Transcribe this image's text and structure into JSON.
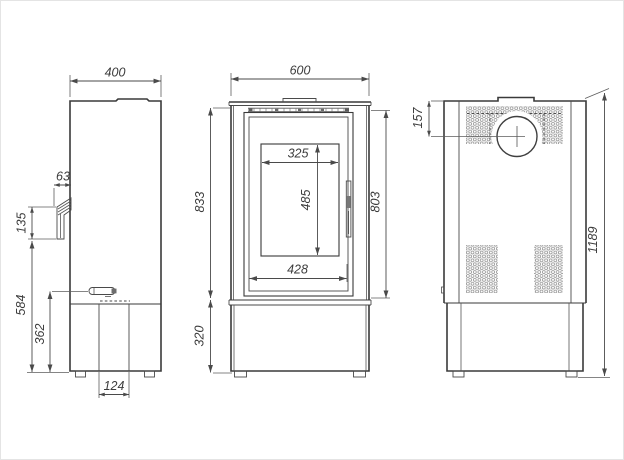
{
  "drawing": {
    "side": {
      "depth": "400",
      "rear_offset": "63",
      "bracket_height": "135",
      "outlet_to_floor": "584",
      "lever_to_floor": "362",
      "base_opening_width": "124"
    },
    "front": {
      "width": "600",
      "body_height": "833",
      "door_height": "803",
      "glass_width": "325",
      "glass_height": "485",
      "door_width": "428",
      "base_height": "320"
    },
    "back": {
      "flue_center_from_top": "157",
      "total_height": "1189"
    }
  }
}
